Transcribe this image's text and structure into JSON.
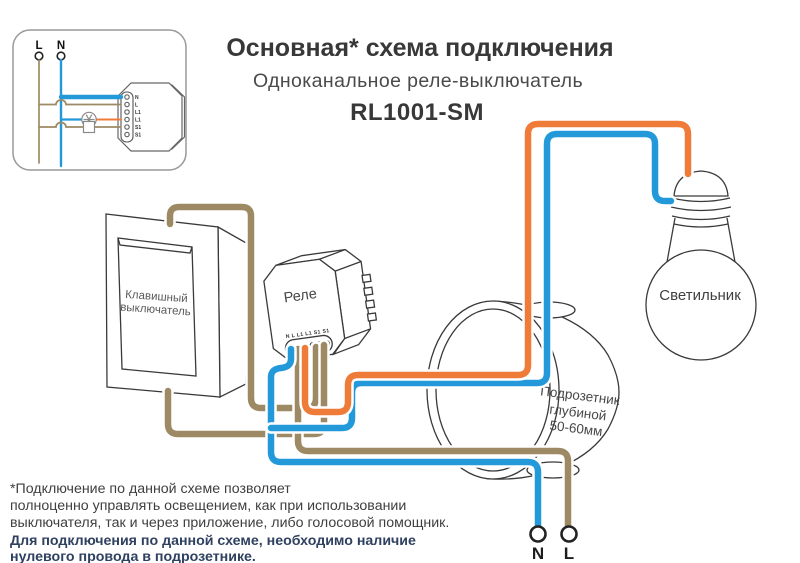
{
  "header": {
    "title": "Основная* схема подключения",
    "subtitle": "Одноканальное реле-выключатель",
    "model": "RL1001-SM"
  },
  "inset": {
    "line_label": "L",
    "neutral_label": "N",
    "terminals": [
      "N",
      "L",
      "L1",
      "L1",
      "S1",
      "S1"
    ]
  },
  "diagram": {
    "switch_label_line1": "Клавишный",
    "switch_label_line2": "выключатель",
    "relay_label": "Реле",
    "relay_terminals": "N L L1 L1 S1 S1",
    "box_label_line1": "Подрозетник",
    "box_label_line2": "глубиной",
    "box_label_line3": "50-60мм",
    "bulb_label": "Светильник",
    "supply_neutral_label": "N",
    "supply_line_label": "L"
  },
  "footnote": {
    "line1": "*Подключение по данной схеме позволяет",
    "line2": "полноценно управлять освещением, как при использовании",
    "line3": "выключателя, так и через приложение, либо голосовой помощник.",
    "line4_bold": "Для подключения по данной схеме, необходимо наличие",
    "line5_bold": "нулевого провода в подрозетнике."
  },
  "colors": {
    "wire_live": "#ef7b38",
    "wire_neutral": "#2499da",
    "wire_switch": "#9d8a64",
    "note_bold": "#2f4160"
  }
}
